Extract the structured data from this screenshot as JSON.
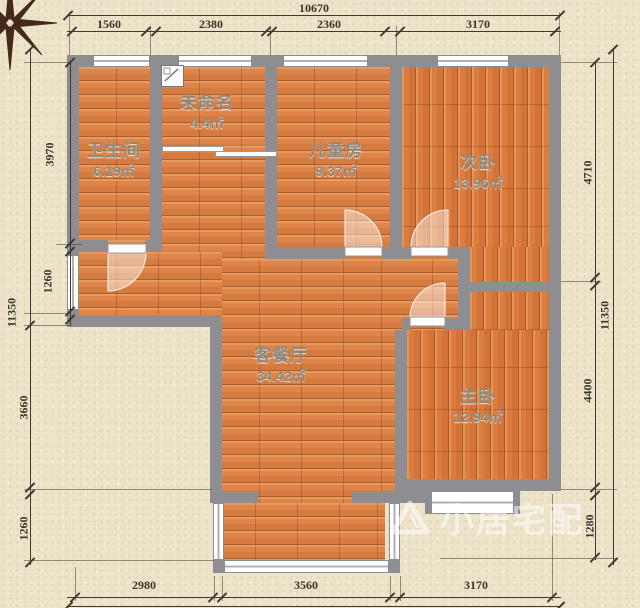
{
  "plan": {
    "rooms": [
      {
        "id": "bathroom",
        "name": "卫生间",
        "area": "6.19㎡"
      },
      {
        "id": "unnamed",
        "name": "未命名",
        "area": "4.4㎡"
      },
      {
        "id": "kids-room",
        "name": "儿童房",
        "area": "9.37㎡"
      },
      {
        "id": "second-bedroom",
        "name": "次卧",
        "area": "13.96㎡"
      },
      {
        "id": "living-dining",
        "name": "客餐厅",
        "area": "34.42㎡"
      },
      {
        "id": "master-bedroom",
        "name": "主卧",
        "area": "12.94㎡"
      }
    ]
  },
  "dimensions": {
    "top": {
      "total": "10670",
      "segments": [
        "1560",
        "2380",
        "2360",
        "3170"
      ]
    },
    "bottom": {
      "segments": [
        "2980",
        "3560",
        "3170"
      ]
    },
    "left": {
      "total": "11350",
      "segments": [
        "3970",
        "1260",
        "3660",
        "1260"
      ]
    },
    "right": {
      "total": "11350",
      "segments": [
        "4710",
        "4400",
        "1280"
      ]
    }
  },
  "watermark": {
    "text": "小居宅配"
  },
  "icons": {
    "compass": "compass-rose",
    "flue": "flue-shaft"
  },
  "colors": {
    "floor": "#e08549",
    "bedroom_floor": "#dd7c3f",
    "wall": "#8d8d92",
    "paper": "#ece3c9",
    "dim_text": "#3c372c",
    "room_text": "#8d887c"
  }
}
